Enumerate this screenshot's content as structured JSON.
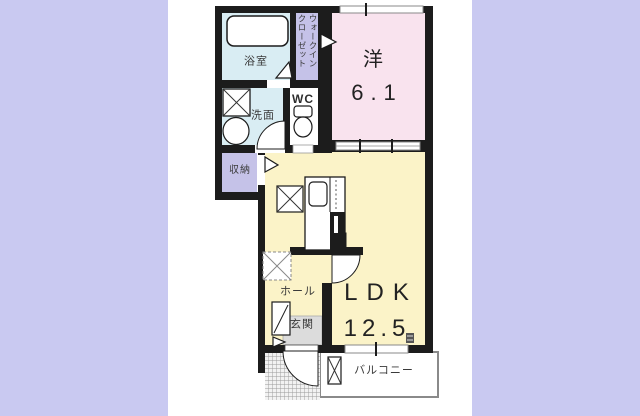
{
  "palette": {
    "page_bg": "#c9c9f1",
    "canvas_bg": "#ffffff",
    "wall": "#1c1c1c",
    "bath_blue": "#d9edf3",
    "closet_lavender": "#c5c2e8",
    "western_pink": "#f9e3ee",
    "ldk_yellow": "#fbf3c8",
    "genkan_gray": "#dcdcdc",
    "outline_gray": "#8a8a8a",
    "text": "#3a3a3a"
  },
  "rooms": {
    "bath": {
      "label": "浴室"
    },
    "walk_in_closet": {
      "label": "ウォークインクローゼット",
      "line1": "ウォークイン",
      "line2": "クローゼット"
    },
    "washroom": {
      "label": "洗面"
    },
    "wc": {
      "label": "WC"
    },
    "storage": {
      "label": "収納"
    },
    "western_room": {
      "label": "洋",
      "size": "6.1"
    },
    "ldk": {
      "label": "LDK",
      "size": "12.5"
    },
    "hall": {
      "label": "ホール"
    },
    "entrance": {
      "label": "玄関"
    },
    "balcony": {
      "label": "バルコニー"
    }
  },
  "icons": {
    "bathtub": "bathtub-icon",
    "washing_machine": "washing-machine-icon",
    "basin": "basin-icon",
    "toilet": "toilet-icon",
    "kitchen": "kitchen-counter-icon",
    "refrigerator_space": "refrigerator-space-icon",
    "appliance_space": "appliance-space-icon",
    "shoe_cabinet": "shoe-cabinet-icon",
    "balcony_partition": "balcony-partition-icon"
  }
}
